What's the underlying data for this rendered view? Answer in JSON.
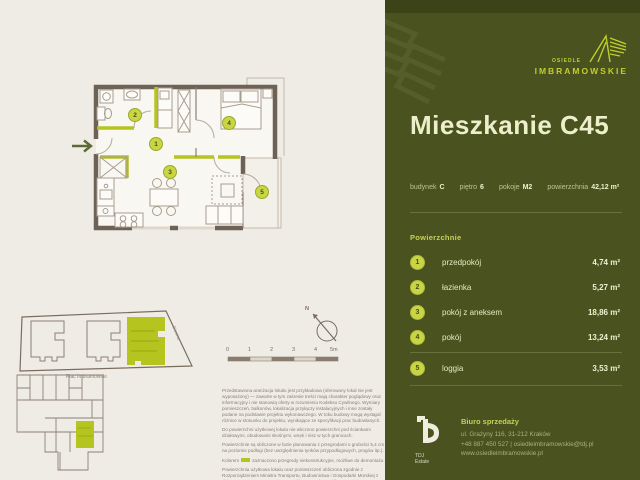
{
  "brand": {
    "line1": "OSIEDLE",
    "line2": "IMBRAMOWSKIE"
  },
  "header": {
    "title": "Mieszkanie C45"
  },
  "details": [
    {
      "label": "budynek",
      "value": "C"
    },
    {
      "label": "piętro",
      "value": "6"
    },
    {
      "label": "pokoje",
      "value": "M2"
    },
    {
      "label": "powierzchnia",
      "value": "42,12 m²"
    }
  ],
  "areas": {
    "heading": "Powierzchnie",
    "rooms": [
      {
        "num": "1",
        "name": "przedpokój",
        "area": "4,74 m²"
      },
      {
        "num": "2",
        "name": "łazienka",
        "area": "5,27 m²"
      },
      {
        "num": "3",
        "name": "pokój z aneksem",
        "area": "18,86 m²"
      },
      {
        "num": "4",
        "name": "pokój",
        "area": "13,24 m²"
      }
    ],
    "loggia": {
      "num": "5",
      "name": "loggia",
      "area": "3,53 m²"
    }
  },
  "contact": {
    "logo_top": "TDJ",
    "logo_bottom": "Estate",
    "heading": "Biuro sprzedaży",
    "address": "ul. Grażyny 116, 31-212 Kraków",
    "phone_email": "+48 887 450 527 | osiedleimbramowskie@tdj.pl",
    "website": "www.osiedleimbramowskie.pl"
  },
  "site_map": {
    "place_label": "Plac Imbramowski",
    "street_label": "Siewna"
  },
  "scale_bar": {
    "ticks": [
      "0",
      "1",
      "2",
      "3",
      "4",
      "5m"
    ]
  },
  "compass": {
    "north_label": "N"
  },
  "legal": {
    "p1": "Przedstawiona aranżacja lokalu jest przykładowa (oferowany lokal nie jest wyposażony) — zawarte w tym zakresie treści mają charakter poglądowy oraz informacyjny i nie stanowią oferty w rozumieniu Kodeksu Cywilnego. Wymiary pomieszczeń, balkonów, lokalizacja przyłączy instalacyjnych i inne zostały podane na podstawie projektu wykonawczego. W toku budowy mogą wystąpić różnice w stosunku do projektu, wynikające ze specyfikacji prac budowlanych.",
    "p2": "Do powierzchni użytkowej lokalu nie wliczono powierzchni pod ściankami działowymi, obudowami skośnymi, wnęk i nisz w tych granicach.",
    "p3": "Powierzchnie są obliczone w fazie planowania z przegrodami o grubości 5,4 cm na poziomie podłogi (bez uwzględnienia tynków przypodłogowych, progów itp.).",
    "p4_before": "Kolorem",
    "p4_after": "zaznaczono przegrody niekonstrukcyjne, możliwe do demontażu.",
    "p5": "Powierzchnia użytkowa lokalu oraz pomieszczeń obliczona zgodnie z Rozporządzeniem Ministra Transportu, Budownictwa i Gospodarki Morskiej z dnia 25.04.2012 r. w sprawie szczegółowego zakresu i formy projektu budowlanego oraz treścią Polskiej normy PN-ISO 9836:2015-12."
  },
  "colors": {
    "panel_green": "#4a5220",
    "accent_green": "#becf2e",
    "highlight_green": "#b5c41f",
    "wall_brown": "#6e6156",
    "background": "#efece6"
  }
}
